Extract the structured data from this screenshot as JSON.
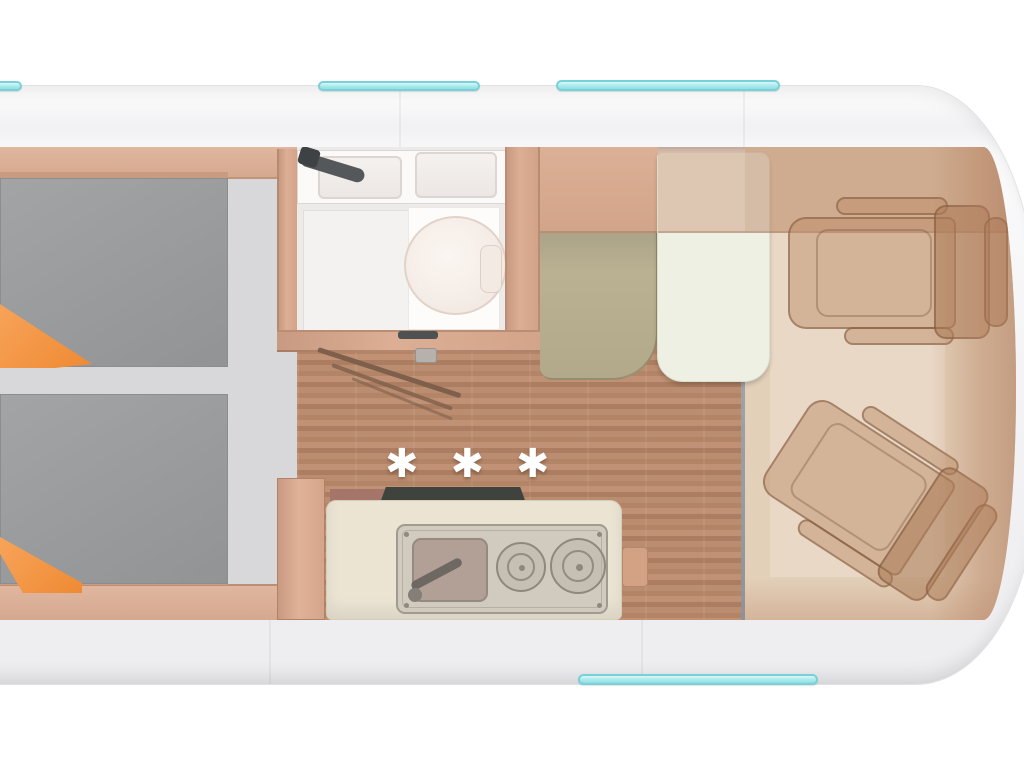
{
  "floorplan": {
    "marks": "✱ ✱ ✱",
    "colors": {
      "accent_teal": "#a9e9ed",
      "accent_teal_border": "#79d1d8",
      "body_white": "#f6f6f7",
      "wood_floor": "#b5866a",
      "cabinet_wood": "#dcae94",
      "bed_gray": "#9a9b9c",
      "blanket_orange": "#f2913f",
      "bench_olive": "#b7ae8f",
      "table_cream": "#eef0e4",
      "counter_cream": "#ebe4d3",
      "counter_dark": "#3f433e",
      "seat_tan": "#c49a76",
      "divider_gray": "#98a0a9",
      "fixture_white": "#fbfafa"
    }
  }
}
